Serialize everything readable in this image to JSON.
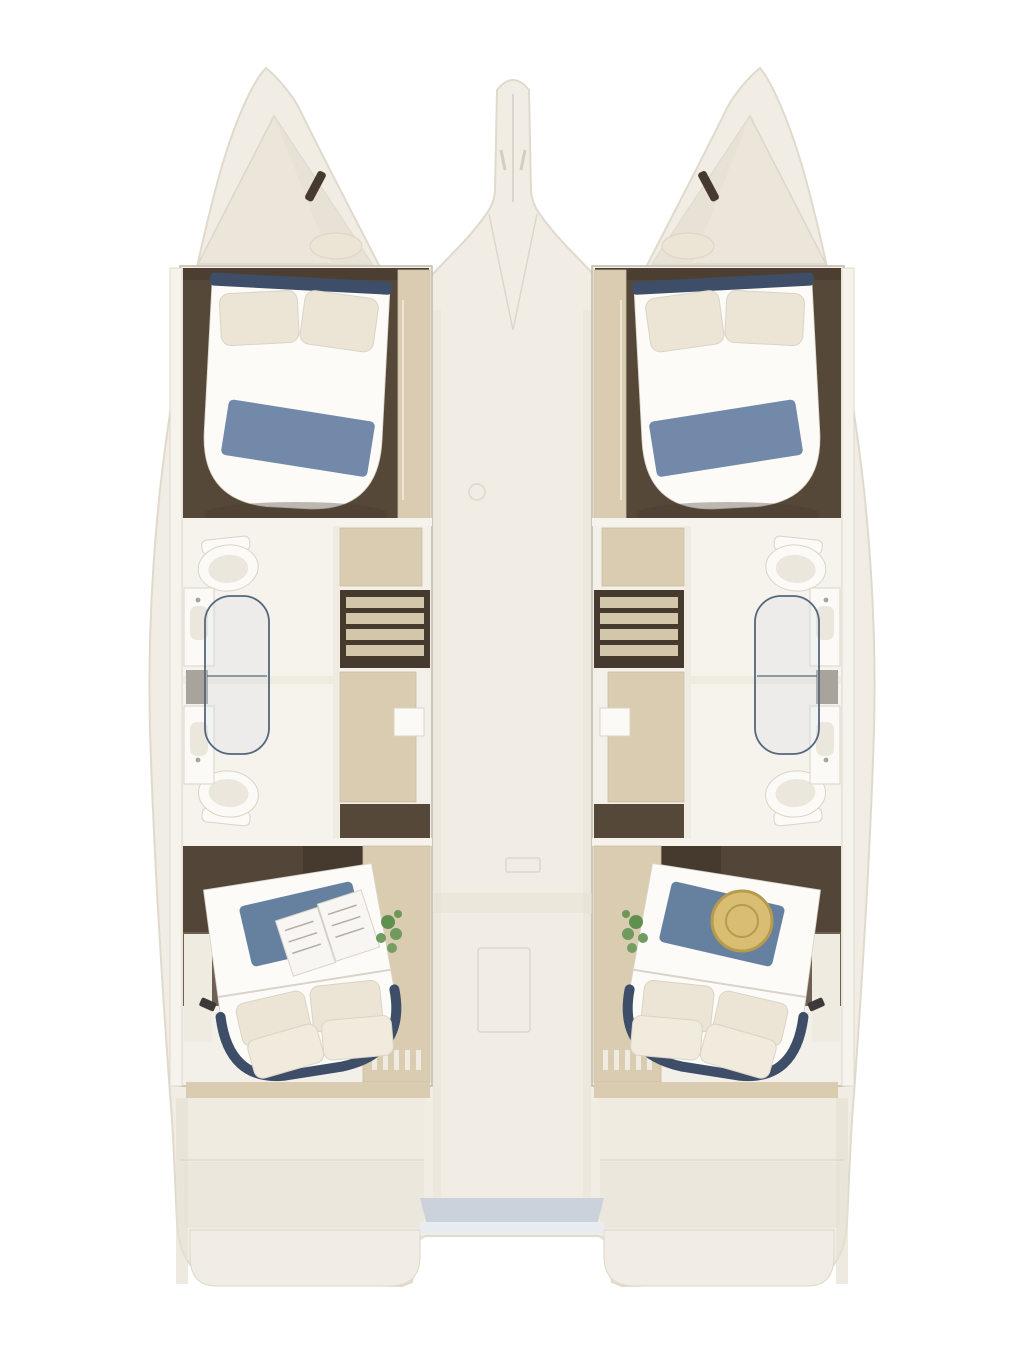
{
  "canvas": {
    "width": 1024,
    "height": 1365
  },
  "scene": {
    "type": "catamaran-interior-floor-plan-top-view",
    "hulls": [
      "port",
      "starboard"
    ],
    "cabins_per_hull": 2,
    "bathrooms_per_hull": 2,
    "fixtures": [
      "double-bed",
      "pillows",
      "blue-blanket",
      "toilet",
      "shower-glass",
      "vanity-sink",
      "mirror",
      "companionway-stairs",
      "wardrobe",
      "plant",
      "straw-hat",
      "open-book",
      "transom-steps",
      "bowsprit",
      "deck-hatch",
      "cockpit"
    ]
  },
  "palette": {
    "background": "#ffffff",
    "hull_shell": "#f1ede4",
    "hull_edge": "#e0dacd",
    "hull_shadow": "#e7e1d4",
    "forepeak": "#ece6da",
    "cutaway_floor": "#f3f0e9",
    "cutaway_rim": "#c0b9aa",
    "wood_dark": "#564838",
    "wood_deep": "#463a2f",
    "cabinet_tan": "#d9ccb1",
    "cabinet_tan_dark": "#cbbea2",
    "wall_white": "#f6f3ec",
    "bed_white": "#fcfbf8",
    "pillow_cream": "#ece5d5",
    "pillow_cream_light": "#f1ebdd",
    "blanket_blue": "#7389a9",
    "blanket_blue_dark": "#66809f",
    "bed_trim_navy": "#3f4e68",
    "porcelain": "#fbfaf6",
    "fixture_stroke": "#d9d4c8",
    "glass_stroke": "#54677d",
    "glass_fill": "rgba(205,216,228,0.22)",
    "mirror_gray": "#a8a49b",
    "tread_tan": "#d3c6aa",
    "step_white": "#efebe1",
    "step_white_2": "#ece7dc",
    "deck_line": "#ddd7cb",
    "shadow_soft": "#e7e1d4",
    "cockpit_blue": "#ccd2db",
    "cockpit_light": "#e8ebef",
    "plant_green": "#5e9150",
    "hat_gold": "#d9bd72",
    "hat_gold_dark": "#b89a4e",
    "book_page": "#f7f6f2",
    "book_line": "#b3aea4",
    "item_dark": "#3c3b38"
  }
}
